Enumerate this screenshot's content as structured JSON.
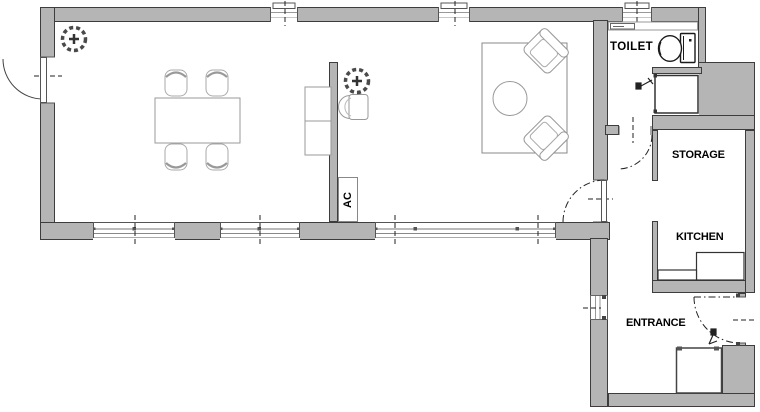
{
  "plan": {
    "title": "apartment-floor-plan",
    "labels": {
      "toilet": "TOILET",
      "storage": "STORAGE",
      "kitchen": "KITCHEN",
      "entrance": "ENTRANCE",
      "ac": "AC"
    },
    "colors": {
      "wall_fill": "#b5b5b5",
      "wall_outline": "#3d3d3d",
      "fixture_stroke": "#1a1a1a",
      "furniture_stroke": "#999999",
      "label_color": "#000000",
      "background": "#ffffff"
    },
    "icons": [
      "ceiling-light-icon",
      "tap-icon",
      "toilet-icon",
      "basin-icon",
      "shower-icon",
      "door-swing-arc",
      "window-centerline-tick"
    ],
    "furniture": [
      "dining-table",
      "dining-chairs",
      "sideboard",
      "tub-chair",
      "rug",
      "coffee-table",
      "armchairs",
      "kitchen-counter",
      "wall-shelf"
    ]
  }
}
